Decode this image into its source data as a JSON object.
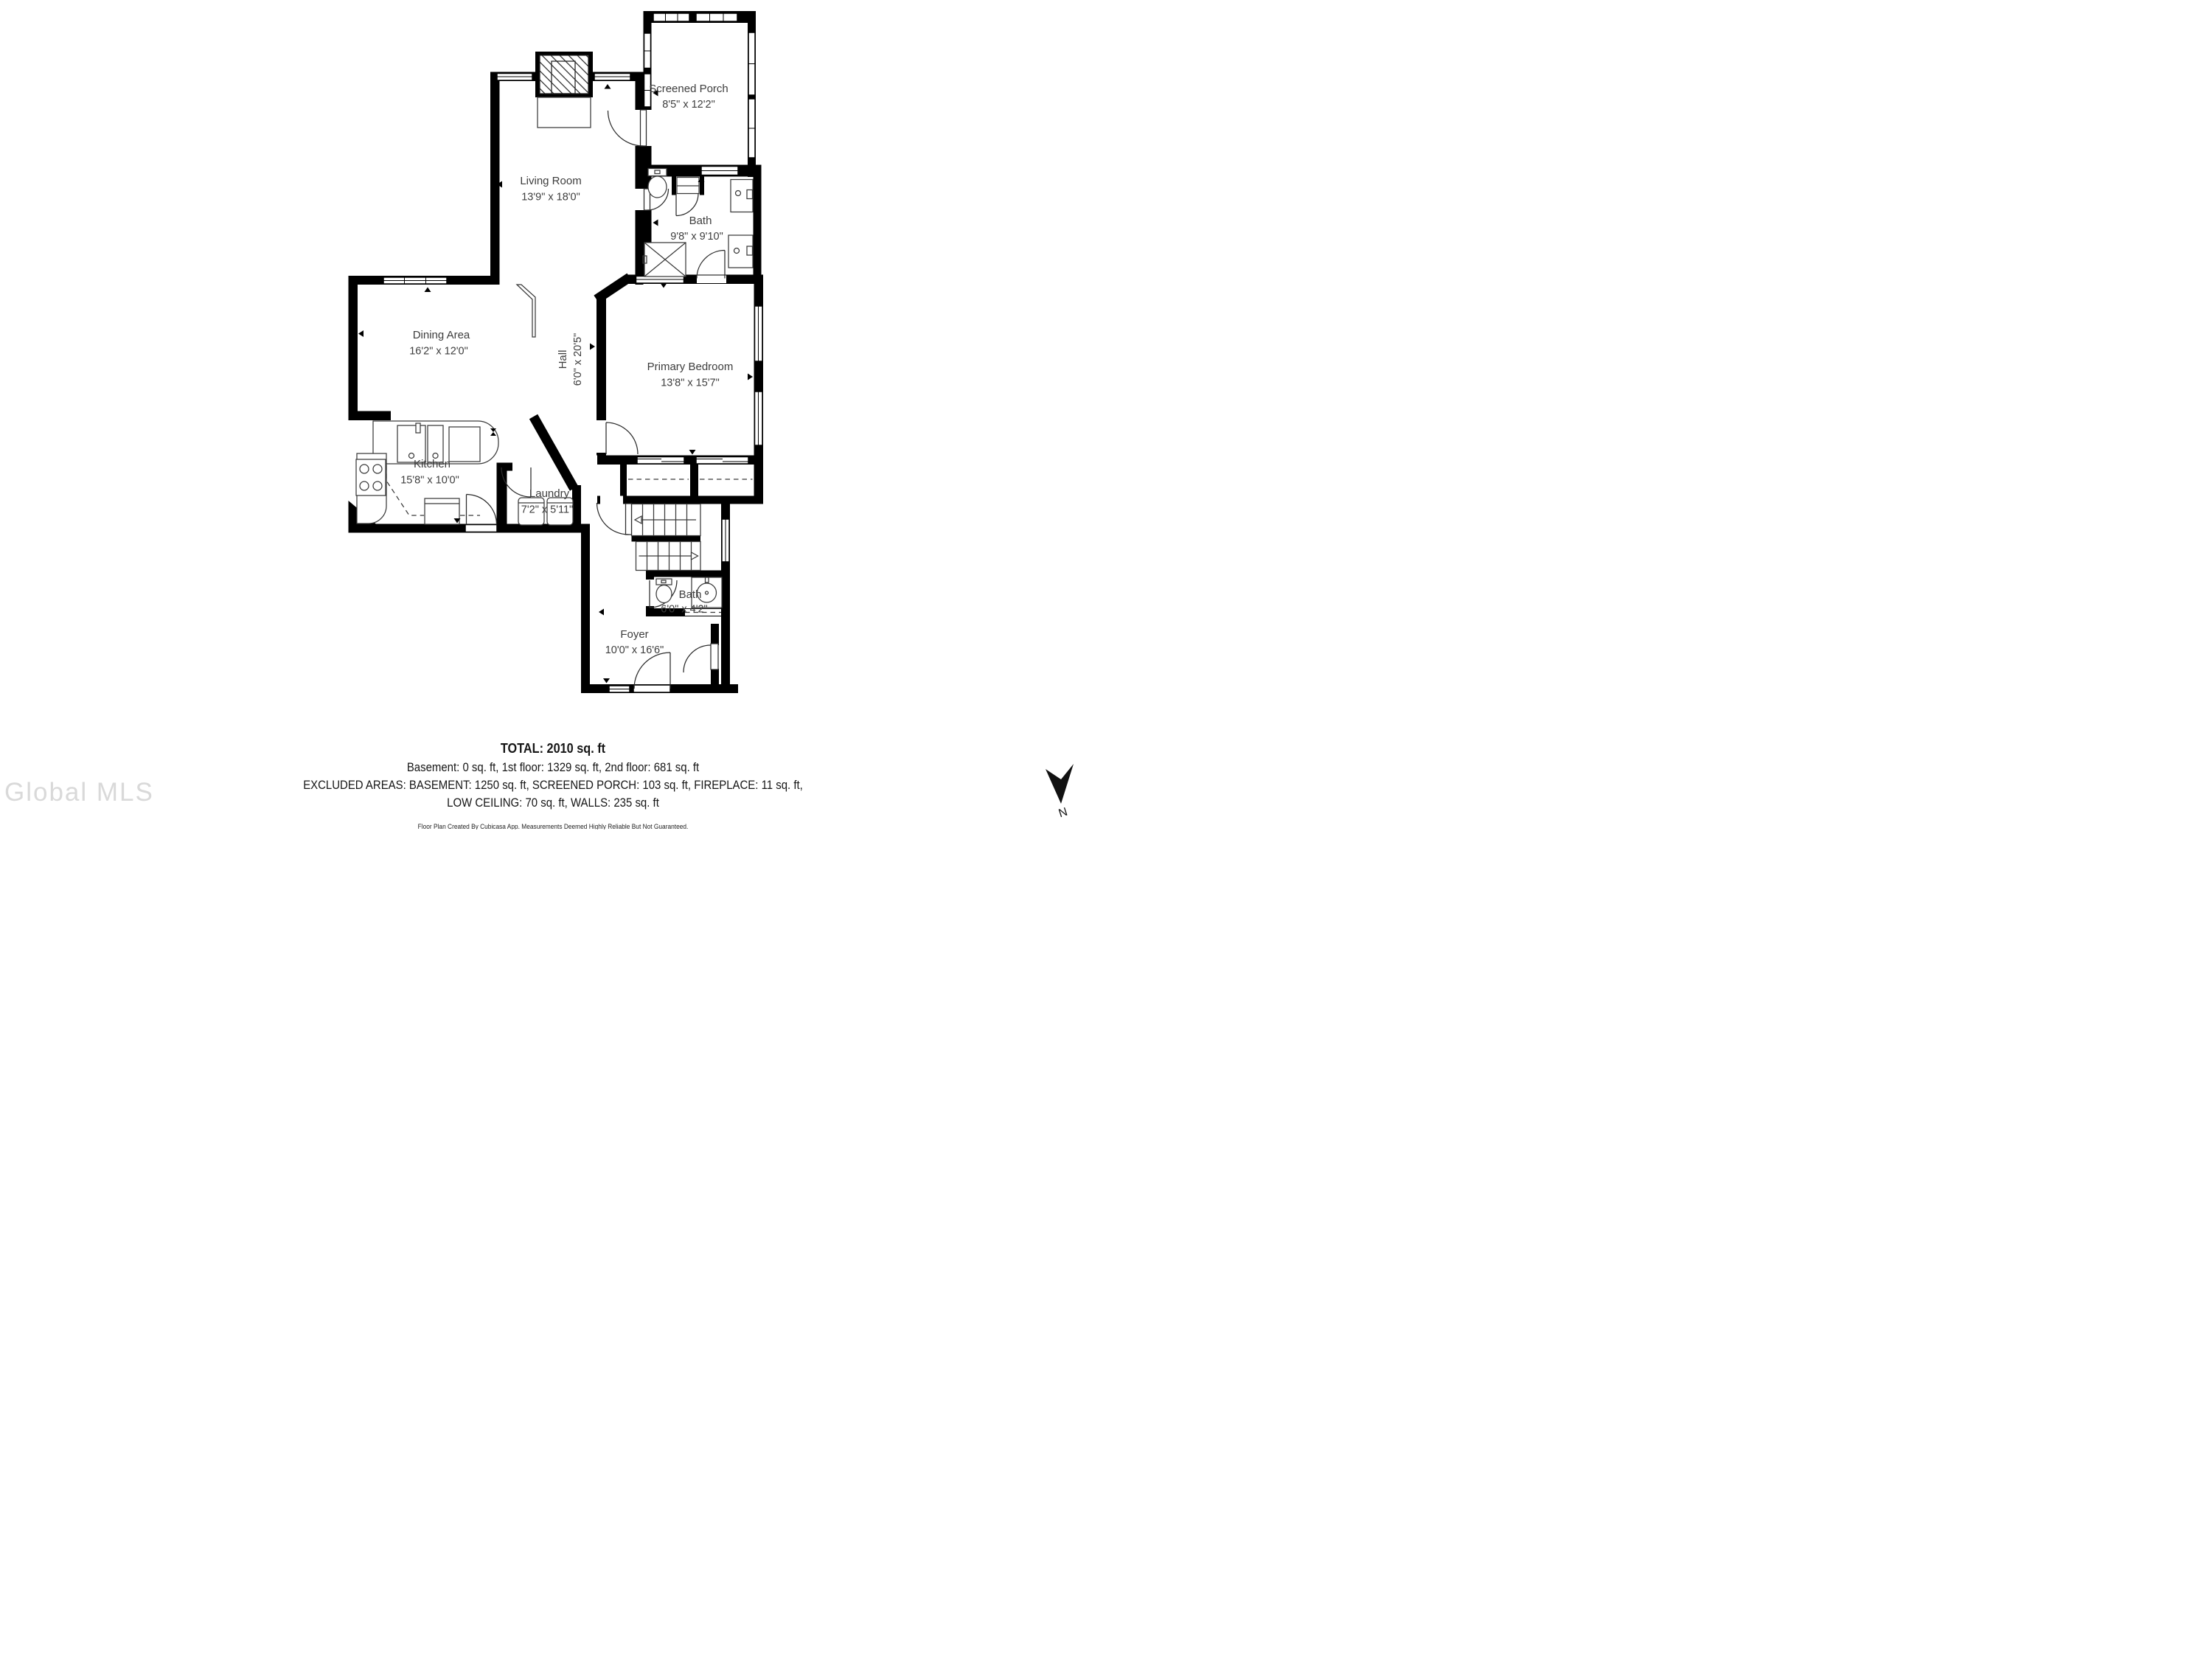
{
  "plan": {
    "rooms": [
      {
        "id": "screened-porch",
        "name": "Screened Porch",
        "dims": "8'5\" x 12'2\""
      },
      {
        "id": "living-room",
        "name": "Living Room",
        "dims": "13'9\" x 18'0\""
      },
      {
        "id": "bath-upper",
        "name": "Bath",
        "dims": "9'8\" x 9'10\""
      },
      {
        "id": "dining-area",
        "name": "Dining Area",
        "dims": "16'2\" x 12'0\""
      },
      {
        "id": "hall",
        "name": "Hall",
        "dims": "6'0\" x 20'5\""
      },
      {
        "id": "primary-bedroom",
        "name": "Primary Bedroom",
        "dims": "13'8\" x 15'7\""
      },
      {
        "id": "kitchen",
        "name": "Kitchen",
        "dims": "15'8\" x 10'0\""
      },
      {
        "id": "laundry",
        "name": "Laundry",
        "dims": "7'2\" x 5'11\""
      },
      {
        "id": "bath-lower",
        "name": "Bath",
        "dims": "6'0\" x 4'2\""
      },
      {
        "id": "foyer",
        "name": "Foyer",
        "dims": "10'0\" x 16'6\""
      }
    ]
  },
  "summary": {
    "total": "TOTAL: 2010 sq. ft",
    "floors": "Basement: 0 sq. ft, 1st floor: 1329 sq. ft, 2nd floor: 681 sq. ft",
    "excluded_1": "EXCLUDED AREAS: BASEMENT: 1250 sq. ft, SCREENED PORCH: 103 sq. ft, FIREPLACE: 11 sq. ft,",
    "excluded_2": "LOW CEILING: 70 sq. ft, WALLS: 235 sq. ft",
    "credit": "Floor Plan Created By Cubicasa App. Measurements Deemed Highly Reliable But Not Guaranteed."
  },
  "watermark": {
    "text": "Global MLS"
  },
  "compass": {
    "label": "N"
  },
  "colors": {
    "wall": "#000000",
    "label": "#3d3d3d",
    "summary": "#161616",
    "watermark": "#d9d9d9"
  }
}
